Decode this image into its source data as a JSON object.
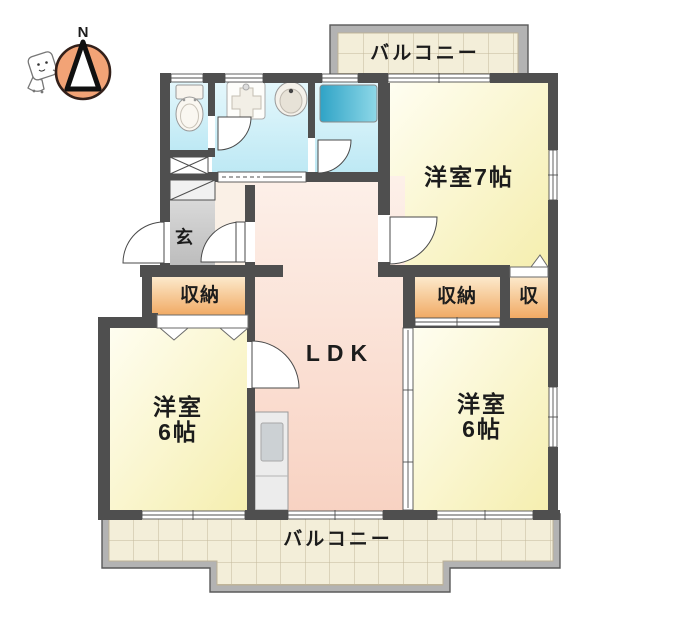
{
  "title": "apartment-floor-plan",
  "compass": {
    "north_label": "N"
  },
  "rooms": {
    "balcony_top": {
      "label": "バルコニー"
    },
    "balcony_bottom": {
      "label": "バルコニー"
    },
    "western_room_7": {
      "label": "洋室7帖"
    },
    "western_room_6_left": {
      "label_line1": "洋室",
      "label_line2": "6帖"
    },
    "western_room_6_right": {
      "label_line1": "洋室",
      "label_line2": "6帖"
    },
    "ldk": {
      "label": "LDK"
    },
    "entrance": {
      "label": "玄"
    },
    "closet_left": {
      "label": "収納"
    },
    "closet_right": {
      "label": "収納"
    },
    "closet_small": {
      "label": "収"
    }
  },
  "colors": {
    "wall": "#4f4f4f",
    "wet_room": "#cdeef8",
    "tatami_room": "#f8f1bc",
    "ldk_floor": "#f9d8ca",
    "hall_floor": "#faf0e6",
    "closet": "#f2a963",
    "entrance_floor": "#c6c6c6",
    "balcony_tile": "#f3eed9",
    "bathtub": "#3fb0d0",
    "compass_circle": "#f2a376"
  }
}
